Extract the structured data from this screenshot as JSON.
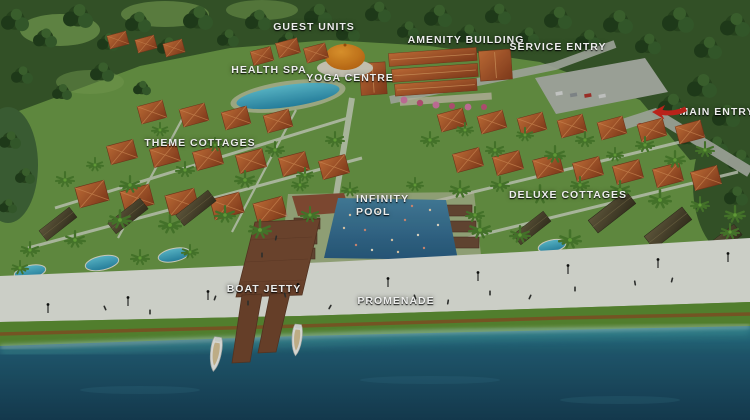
{
  "labels": {
    "guest_units": "GUEST UNITS",
    "amenity_building": "AMENITY BUILDING",
    "service_entry": "SERVICE ENTRY",
    "health_spa": "HEALTH SPA",
    "yoga_centre": "YOGA CENTRE",
    "main_entry": "MAIN ENTRY",
    "theme_cottages": "THEME COTTAGES",
    "deluxe_cottages": "DELUXE COTTAGES",
    "infinity_pool_line1": "INFINITY",
    "infinity_pool_line2": "POOL",
    "boat_jetty": "BOAT JETTY",
    "promenade": "PROMENADE"
  },
  "colors": {
    "arrow_red": "#c8251d",
    "forest_green": "#3a5a2c",
    "lawn_green": "#6d9a48",
    "roof_terracotta": "#b5532c",
    "roof_dark": "#4f4733",
    "pool_blue": "#3fa8c9",
    "infinity_pool_blue": "#35688e",
    "promenade_white": "#e9eae4",
    "water_deep": "#173f58",
    "water_shore": "#2c7f92",
    "jetty_brown": "#7a4a33",
    "dome_orange": "#e07818"
  }
}
